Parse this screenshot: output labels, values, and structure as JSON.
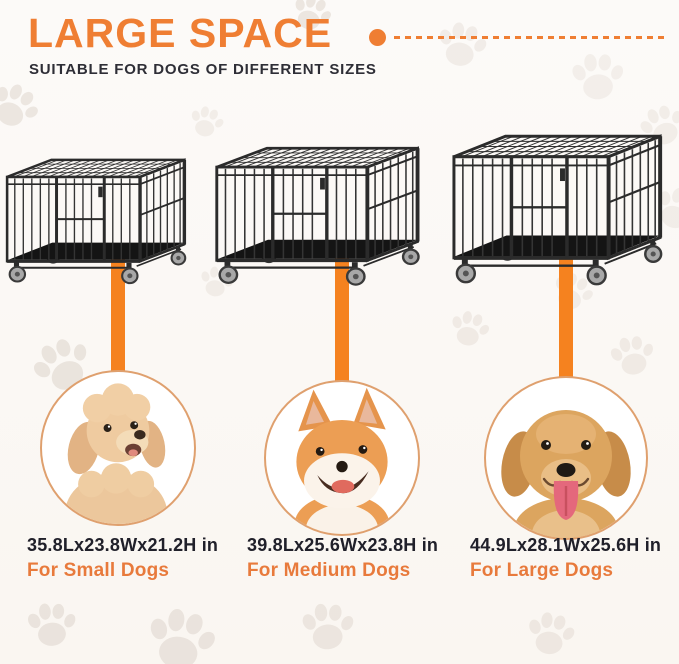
{
  "header": {
    "title": "LARGE SPACE",
    "subtitle": "SUITABLE FOR DOGS OF DIFFERENT SIZES"
  },
  "items": [
    {
      "size": "small",
      "dimensions": "35.8Lx23.8Wx21.2H in",
      "label": "For Small Dogs",
      "dog": "poodle"
    },
    {
      "size": "medium",
      "dimensions": "39.8Lx25.6Wx23.8H in",
      "label": "For Medium Dogs",
      "dog": "shiba-inu"
    },
    {
      "size": "large",
      "dimensions": "44.9Lx28.1Wx25.6H in",
      "label": "For Large Dogs",
      "dog": "golden-retriever"
    }
  ],
  "icons": {
    "paw_watermark": "paw-print-icon",
    "title_bullet": "dot-dash-divider"
  },
  "colors": {
    "accent_orange": "#EF7E33",
    "connector_orange": "#F5821F",
    "label_orange": "#E87A3C",
    "text_dark": "#20202A",
    "background": "#FBF8F4",
    "paw_watermark": "#E9E2DB",
    "crate_frame": "#2B2B2B",
    "circle_border": "#DFA06E"
  }
}
